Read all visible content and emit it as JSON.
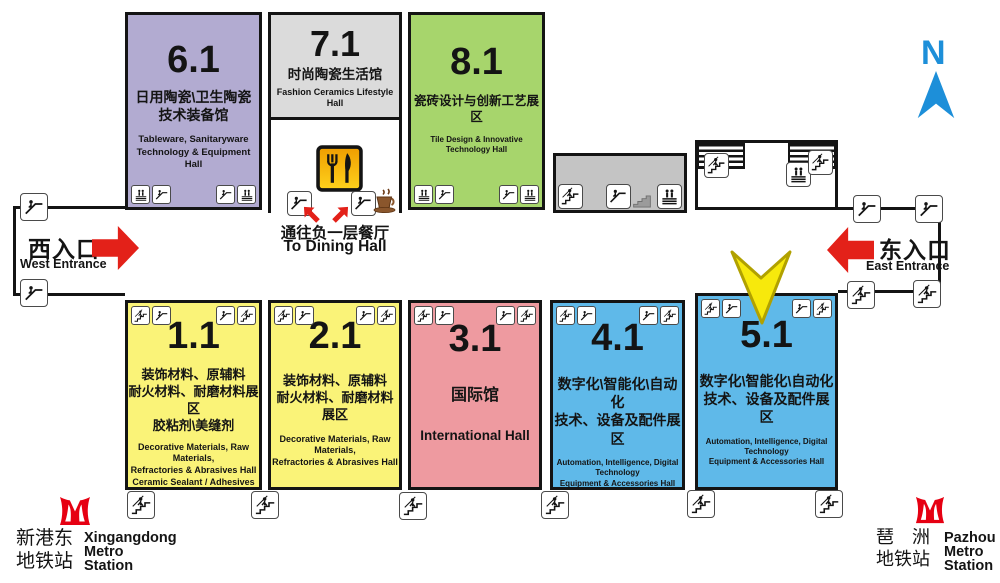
{
  "title": "Exhibition venue floor plan",
  "compass": {
    "label": "N",
    "color": "#1d8fd9"
  },
  "entrances": {
    "west": {
      "zh": "西入口",
      "en": "West Entrance"
    },
    "east": {
      "zh": "东入口",
      "en": "East Entrance"
    }
  },
  "dining": {
    "zh": "通往负一层餐厅",
    "en": "To Dining Hall"
  },
  "stations": {
    "west": {
      "zh": "新港东\n地铁站",
      "en": "Xingangdong\nMetro\nStation"
    },
    "east": {
      "zh": "琶　洲\n地铁站",
      "en": "Pazhou\nMetro\nStation"
    }
  },
  "halls": [
    {
      "number": "6.1",
      "zh": "日用陶瓷\\卫生陶瓷\n技术装备馆",
      "en": "Tableware, Sanitaryware\nTechnology & Equipment Hall",
      "color": "#b2abd1"
    },
    {
      "number": "7.1",
      "zh": "时尚陶瓷生活馆",
      "en": "Fashion Ceramics Lifestyle Hall",
      "color": "#dbdbdb"
    },
    {
      "number": "8.1",
      "zh": "瓷砖设计与创新工艺展区",
      "en": "Tile Design & Innovative Technology Hall",
      "color": "#a7d56c"
    },
    {
      "number": "1.1",
      "zh": "装饰材料、原辅料\n耐火材料、耐磨材料展区\n胶粘剂\\美缝剂",
      "en": "Decorative Materials, Raw Materials,\nRefractories & Abrasives Hall\nCeramic Sealant / Adhesives",
      "color": "#faf378"
    },
    {
      "number": "2.1",
      "zh": "装饰材料、原辅料\n耐火材料、耐磨材料展区",
      "en": "Decorative Materials, Raw Materials,\nRefractories & Abrasives Hall",
      "color": "#faf378"
    },
    {
      "number": "3.1",
      "zh": "国际馆",
      "en": "International Hall",
      "color": "#ee9aa0"
    },
    {
      "number": "4.1",
      "zh": "数字化\\智能化\\自动化\n技术、设备及配件展区",
      "en": "Automation, Intelligence, Digital Technology\nEquipment & Accessories Hall",
      "color": "#5fb9e9"
    },
    {
      "number": "5.1",
      "zh": "数字化\\智能化\\自动化\n技术、设备及配件展区",
      "en": "Automation, Intelligence, Digital Technology\nEquipment & Accessories Hall",
      "color": "#5fb9e9"
    }
  ],
  "colors": {
    "entrance_arrow": "#e32119",
    "highlight_arrow": "#f7e90c",
    "metro_logo": "#e60012",
    "compass": "#1d8fd9",
    "outline": "#141414",
    "service_box": "#c4c4c4"
  },
  "icons": {
    "escalator-icon": "person on escalator glyph in white rounded box",
    "stairs-icon": "person climbing stairs glyph in white rounded box",
    "elevator-icon": "elevator passengers over striped base in white box",
    "food-court-icon": "fork and knife on orange-yellow sign",
    "coffee-icon": "brown coffee cup with saucer",
    "metro-logo-icon": "red Guangzhou Metro emblem",
    "north-arrow-icon": "blue N with up arrow",
    "highlight-arrow-icon": "yellow arrow pointing down at Hall 5.1"
  }
}
